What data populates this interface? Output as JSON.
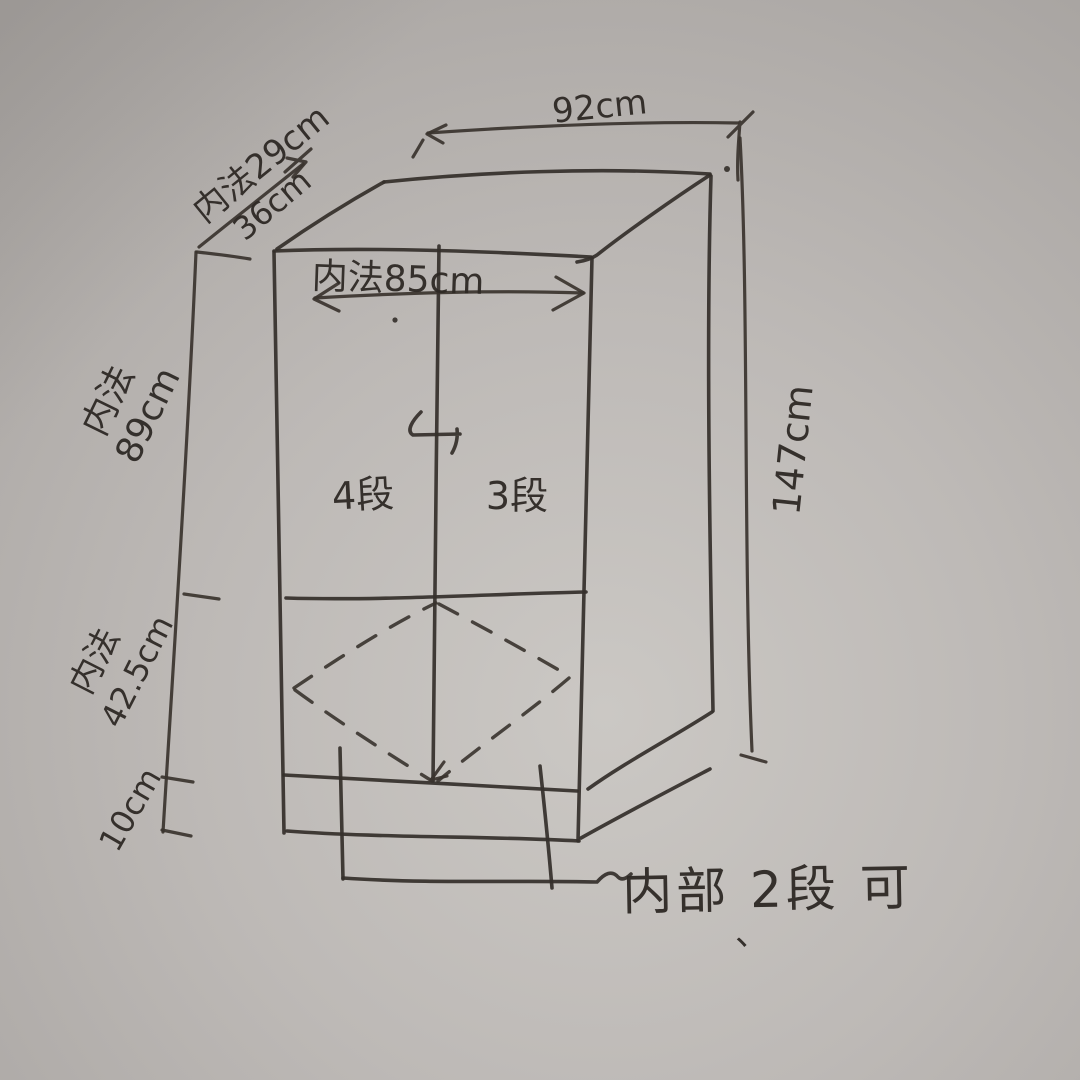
{
  "sketch": {
    "description": "hand-drawn cabinet dimension sketch on gray paper",
    "colors": {
      "paper_light": "#cbc8c4",
      "paper_mid": "#bcb8b5",
      "paper_dark": "#a6a29f",
      "ink": "#352f2b"
    },
    "dimensions": {
      "top_width": "92cm",
      "depth_inner": "内法29cm",
      "depth_outer": "36cm",
      "inner_width": "内法85cm",
      "upper_inner_height_label": "内法",
      "upper_inner_height_value": "89cm",
      "lower_inner_height_label": "内法",
      "lower_inner_height_value": "42.5cm",
      "base_height": "10cm",
      "total_height": "147cm"
    },
    "annotations": {
      "left_bay": "4段",
      "right_bay": "3段",
      "note": "内部 2段 可",
      "note_mark": "、"
    }
  }
}
